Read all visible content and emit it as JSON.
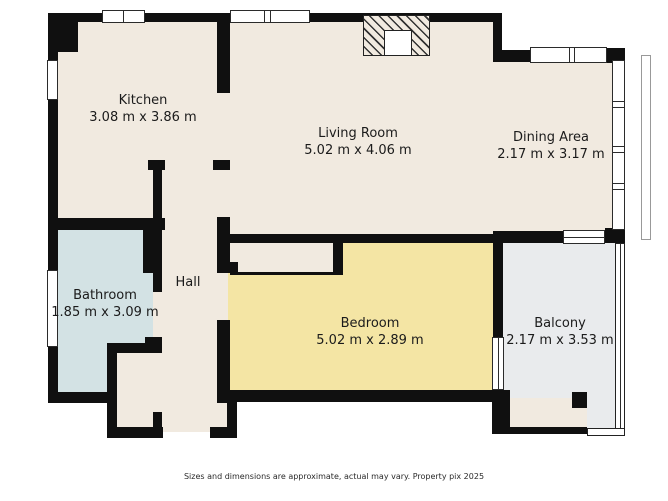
{
  "floorplan": {
    "title": "Apartment floor plan",
    "rooms": {
      "kitchen": {
        "name": "Kitchen",
        "dimensions": "3.08 m x 3.86 m"
      },
      "living_room": {
        "name": "Living Room",
        "dimensions": "5.02 m x 4.06 m"
      },
      "dining_area": {
        "name": "Dining Area",
        "dimensions": "2.17 m x 3.17 m"
      },
      "bathroom": {
        "name": "Bathroom",
        "dimensions": "1.85 m x 3.09 m"
      },
      "hall": {
        "name": "Hall",
        "dimensions": ""
      },
      "bedroom": {
        "name": "Bedroom",
        "dimensions": "5.02 m x 2.89 m"
      },
      "balcony": {
        "name": "Balcony",
        "dimensions": "2.17 m x 3.53 m"
      }
    },
    "disclaimer": "Sizes and dimensions are approximate, actual may vary. Property pix 2025",
    "colors": {
      "wall": "#101010",
      "floor": "#f1eae0",
      "bathroom": "#d3e2e4",
      "bedroom": "#f4e5a4",
      "balcony": "#e9ebed",
      "text": "#1b1b1b",
      "background": "#ffffff"
    }
  }
}
